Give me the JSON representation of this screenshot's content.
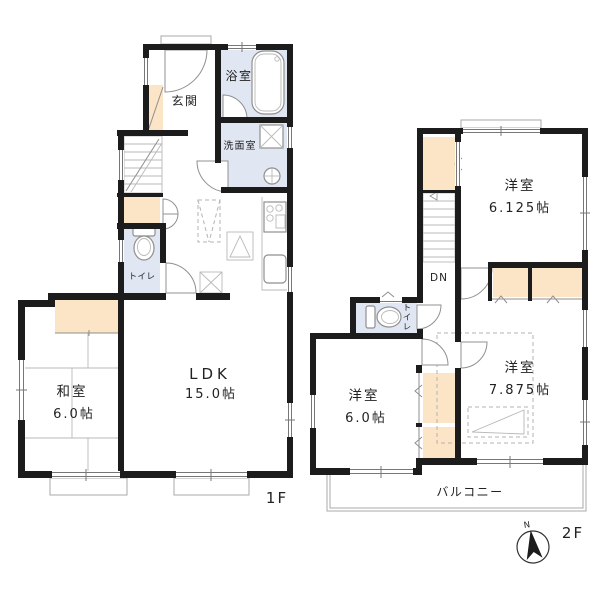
{
  "colors": {
    "wall": "#1c1c1c",
    "wet_floor": "#e0e6f2",
    "closet_floor": "#fbe5c6",
    "outline": "#8f8f8f",
    "text": "#222222"
  },
  "floor1": {
    "floor_label": "1F",
    "genkan": "玄関",
    "bathroom": "浴室",
    "washroom": "洗面室",
    "toilet": "トイレ",
    "washitsu": "和室",
    "washitsu_size": "6.0帖",
    "ldk": "LDK",
    "ldk_size": "15.0帖"
  },
  "floor2": {
    "floor_label": "2F",
    "room_a": "洋室",
    "room_a_size": "6.125帖",
    "stairs_down": "DN",
    "toilet": "トイレ",
    "room_b": "洋室",
    "room_b_size": "6.0帖",
    "room_c": "洋室",
    "room_c_size": "7.875帖",
    "balcony": "バルコニー",
    "compass_north": "N"
  }
}
